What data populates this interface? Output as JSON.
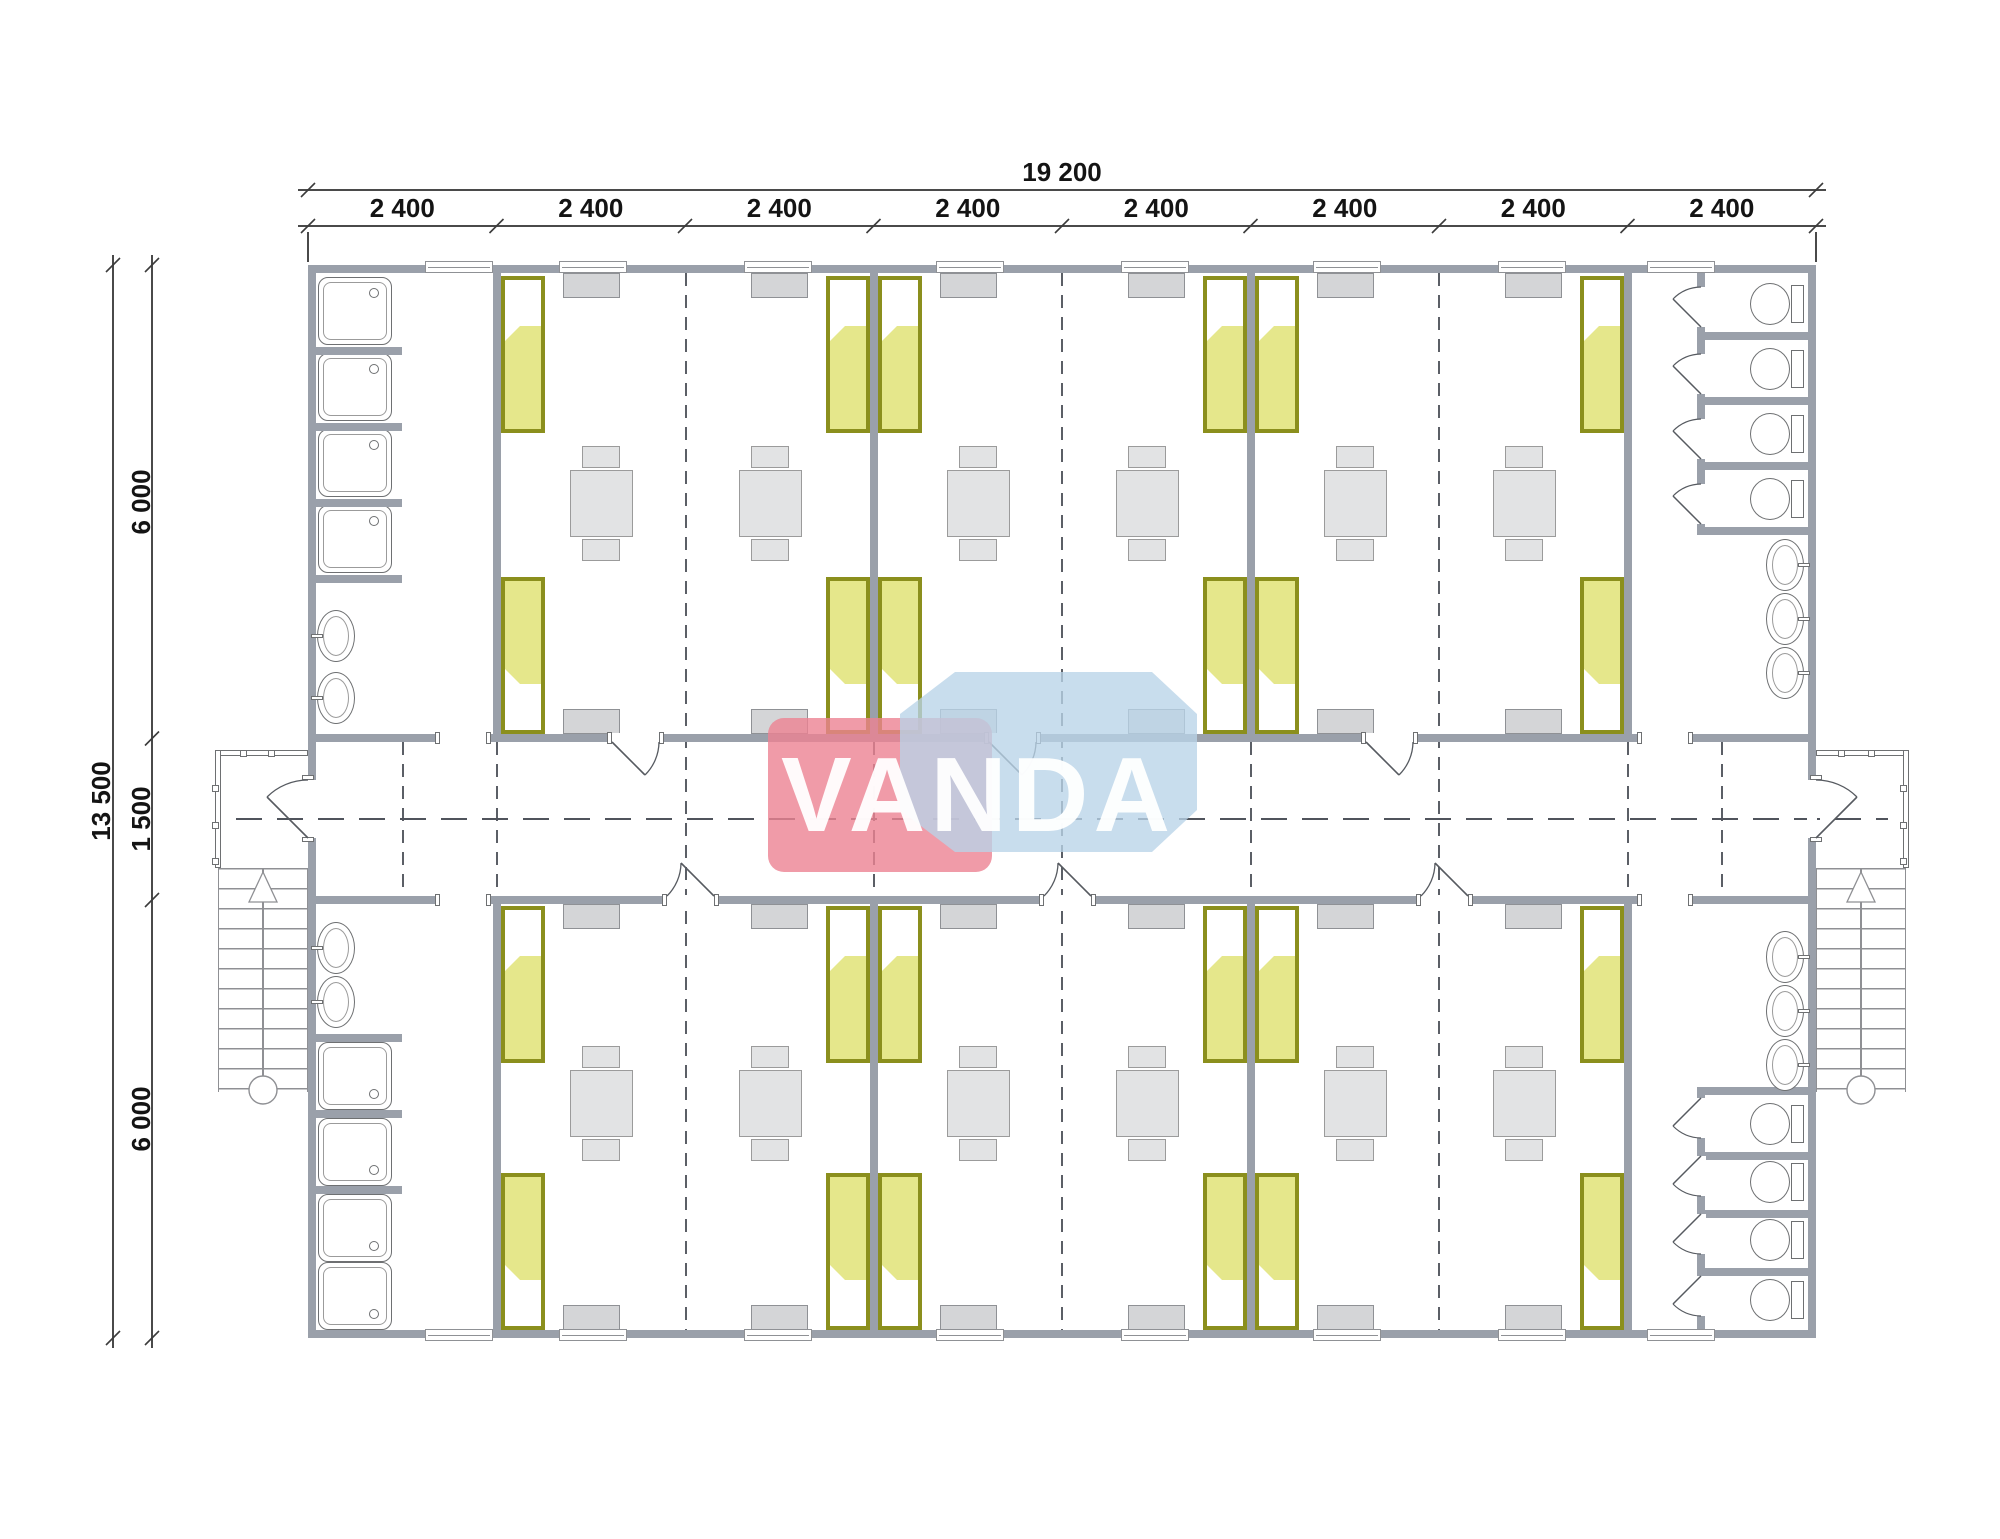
{
  "page": {
    "width": 2000,
    "height": 1539,
    "background": "#ffffff"
  },
  "watermark": {
    "text": "VANDA",
    "red_shape": "#ec8292",
    "blue_shape": "#b9d3e8",
    "text_color": "#ffffff"
  },
  "dimensions": {
    "top_total": "19 200",
    "top_segments": [
      "2 400",
      "2 400",
      "2 400",
      "2 400",
      "2 400",
      "2 400",
      "2 400",
      "2 400"
    ],
    "left_total": "13 500",
    "left_segments": [
      "6 000",
      "1 500",
      "6 000"
    ]
  },
  "inventory": {
    "modules": 8,
    "bedrooms": 6,
    "beds": 24,
    "tables": 12,
    "chairs": 24,
    "cabinets": 24,
    "showers": 8,
    "toilets": 8,
    "wash_basins": 10,
    "staircases": 2,
    "porches": 2,
    "entry_doors": 2,
    "room_doors": 6,
    "wc_stall_doors": 8,
    "washrooms": 4
  },
  "colors": {
    "wall": "#9aa0aa",
    "line": "#6e7072",
    "furniture": "#e2e3e4",
    "furniture_stroke": "#9b9b9b",
    "cabinet": "#d4d5d7",
    "cabinet_stroke": "#8f9195",
    "bed_frame": "#8b8f1d",
    "bed_fill": "#e5e78b",
    "pillow": "#ffffff",
    "dash": "#5b5f66",
    "stair": "#8f9094",
    "dim_line": "#4a4a4a",
    "dim_text": "#141414",
    "door": "#565a60"
  },
  "plan": {
    "building": {
      "x": 308,
      "y": 265,
      "w": 1508,
      "h": 1073,
      "wall_t": 8
    },
    "corridor": {
      "top_wall_y": 734,
      "bot_wall_y": 896,
      "wall_t": 8,
      "center_y": 819,
      "centerline_x1": 236,
      "centerline_x2": 1888
    },
    "module_xs": [
      308,
      496.5,
      685,
      873.5,
      1062,
      1250.5,
      1439,
      1627.5,
      1816
    ],
    "room_wall_xs": [
      497,
      874,
      1251,
      1628
    ],
    "rooms": [
      [
        497,
        874
      ],
      [
        874,
        1251
      ],
      [
        1251,
        1628
      ]
    ],
    "module_dash_xs": [
      685.5,
      1062,
      1438.5
    ],
    "corridor_dash_xs": [
      402.5,
      497,
      874,
      1251,
      1628,
      1722
    ],
    "bed": {
      "w": 44,
      "l": 157,
      "pillow_h": 50
    },
    "cabinet": {
      "w": 57,
      "h": 25
    },
    "window": {
      "w": 68,
      "t": 12
    },
    "table": {
      "w": 63,
      "h": 67,
      "chair_w": 38,
      "chair_h": 22
    },
    "door_w": 47,
    "wash_left_top": {
      "tray_ys": [
        277,
        353,
        429,
        505
      ],
      "stub_ys": [
        347,
        423,
        499,
        575
      ],
      "sink_cys": [
        636,
        698
      ]
    },
    "wash_left_bot": {
      "tray_ys": [
        1042,
        1118,
        1194,
        1262
      ],
      "stub_ys": [
        1034,
        1110,
        1186
      ],
      "sink_cys": [
        948,
        1002
      ]
    },
    "wash_right_top": {
      "front_wall": [
        273,
        262
      ],
      "closure_y": 527,
      "part_ys": [
        332,
        397,
        462
      ],
      "wc_cys": [
        304,
        369,
        434,
        499
      ],
      "stall_tops": [
        273,
        340,
        405,
        470
      ],
      "sink_cys": [
        565,
        619,
        673
      ]
    },
    "wash_right_bot": {
      "front_wall": [
        1095,
        235
      ],
      "closure_y": 1087,
      "part_ys": [
        1152,
        1210,
        1268
      ],
      "wc_cys": [
        1124,
        1182,
        1240,
        1300
      ],
      "stall_bots": [
        1152,
        1210,
        1268,
        1330
      ],
      "sink_cys": [
        957,
        1011,
        1065
      ]
    },
    "washroom_openings_x": [
      440,
      1642
    ],
    "washroom_window_xs": [
      425,
      1647
    ],
    "entry_gap_y": 780,
    "entry_gap_h": 58,
    "porch": {
      "y": 750,
      "h": 118,
      "w": 93
    },
    "stairs": {
      "y": 868,
      "h": 224,
      "tread": 20,
      "left_x": 218,
      "right_x": 1816,
      "circle_y": 1090
    },
    "dims": {
      "top_total_y": 190,
      "top_seg_y": 226,
      "left_total_x": 113,
      "left_seg_x": 152,
      "left_tick_ys": [
        265,
        738.5,
        900,
        1338
      ],
      "top_label_y": 221,
      "total_label_y": 185,
      "left_label_x": 141,
      "left_total_label_x": 101
    }
  }
}
